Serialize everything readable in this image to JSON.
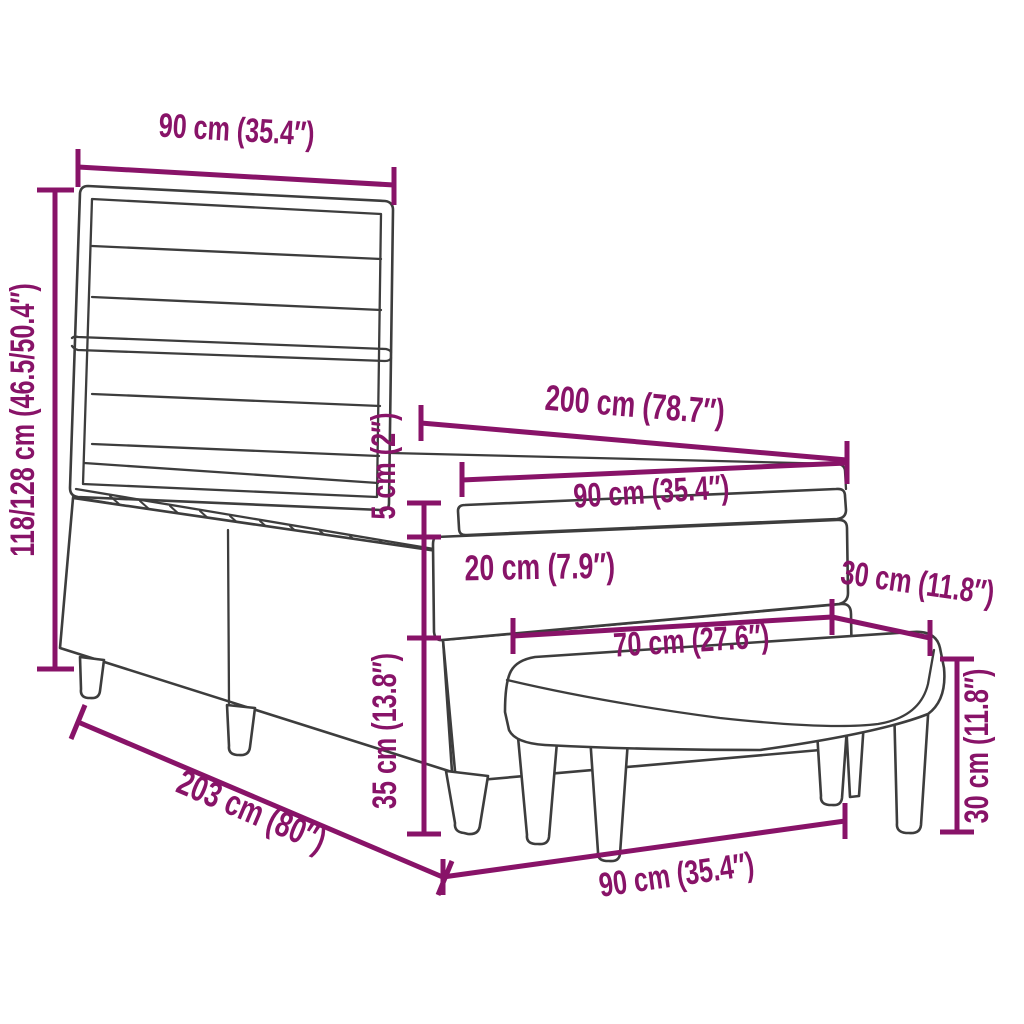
{
  "diagram": {
    "colors": {
      "dimension_accent": "#881368",
      "line_art": "#3d3d3d",
      "background": "#ffffff"
    },
    "dimensions": {
      "headboard_width": {
        "label": "90 cm (35.4″)"
      },
      "overall_height": {
        "label": "118/128 cm (46.5/50.4″)"
      },
      "bed_length": {
        "label": "200 cm (78.7″)"
      },
      "mattress_width": {
        "label": "90 cm (35.4″)"
      },
      "topper_thickness": {
        "label": "5 cm (2″)"
      },
      "mattress_thickness": {
        "label": "20 cm (7.9″)"
      },
      "bench_depth": {
        "label": "30 cm (11.8″)"
      },
      "bench_length": {
        "label": "70 cm (27.6″)"
      },
      "base_height": {
        "label": "35 cm (13.8″)"
      },
      "overall_length": {
        "label": "203 cm (80″)"
      },
      "bench_height": {
        "label": "30 cm (11.8″)"
      },
      "bed_width": {
        "label": "90 cm (35.4″)"
      }
    }
  }
}
